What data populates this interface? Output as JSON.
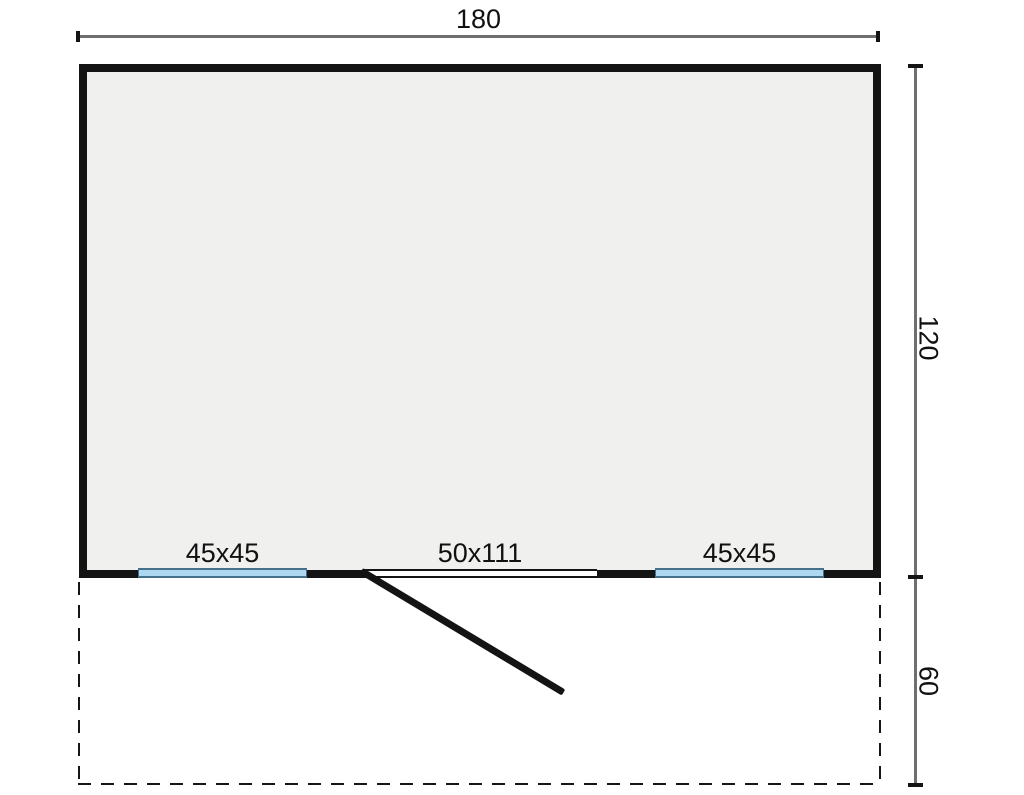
{
  "drawing": {
    "title": "log-cabin-floor-plan",
    "dimensions": {
      "width_label": "180",
      "depth_label": "120",
      "terrace_depth_label": "60"
    },
    "openings": {
      "left_window_label": "45x45",
      "door_label": "50x111",
      "right_window_label": "45x45"
    },
    "colors": {
      "wall": "#141414",
      "floor_fill": "#f0f0ef",
      "window_fill": "#aed7f2",
      "window_border": "#44708c",
      "dimension_line": "#6f6f6f",
      "background": "#ffffff"
    }
  }
}
